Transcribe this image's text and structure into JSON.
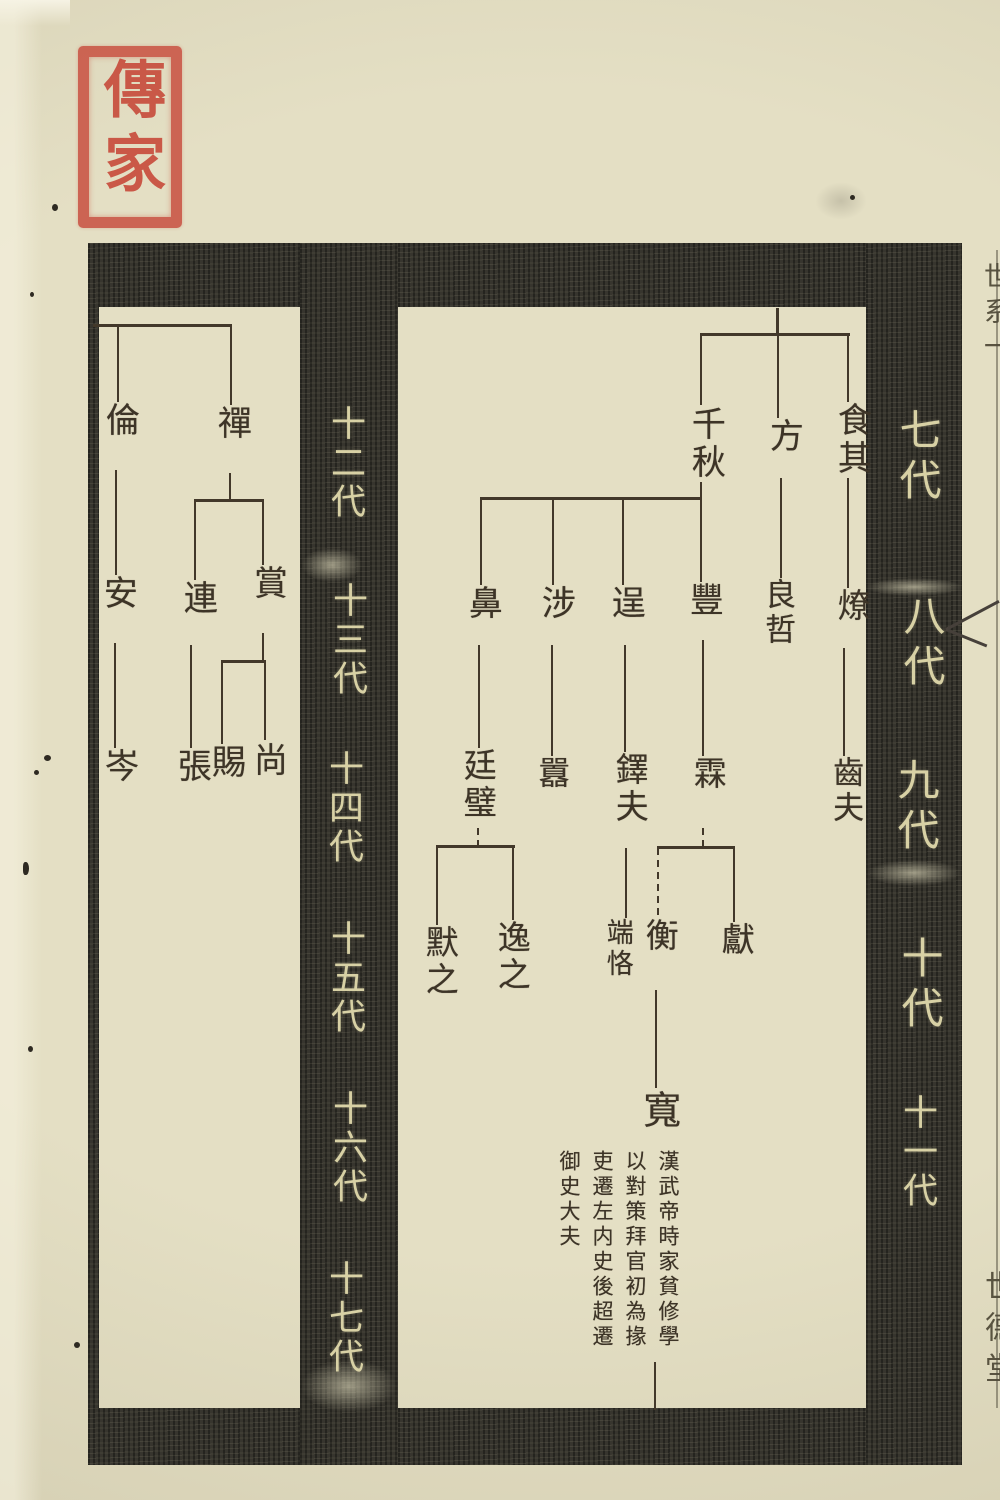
{
  "document": {
    "kind": "woodblock-printed genealogy chart page",
    "colors": {
      "paper": "#e4dfc4",
      "ink": "#3d3427",
      "band": "#32302a",
      "band_text": "#d8d1a5",
      "seal_red": "#c7493a"
    }
  },
  "seal": {
    "text": "傳家"
  },
  "generation_bands": {
    "right_band_labels": [
      "七代",
      "八代",
      "九代",
      "十代",
      "十一代"
    ],
    "center_band_labels": [
      "十二代",
      "十三代",
      "十四代",
      "十五代",
      "十六代",
      "十七代"
    ]
  },
  "names": {
    "qianqiu": "千秋",
    "fang": "方",
    "shiqi": "食其",
    "bi": "鼻",
    "she": "涉",
    "cheng": "逞",
    "feng": "豐",
    "liangzhe": "良哲",
    "liao": "燎",
    "tingbi": "廷璧",
    "xiao": "囂",
    "duofu": "鐸夫",
    "lin": "霖",
    "chifu": "齒夫",
    "mozhi": "默之",
    "yizhi": "逸之",
    "duanke": "端恪",
    "heng": "衡",
    "xian": "獻",
    "kuan": "寬",
    "lun": "倫",
    "chan": "禪",
    "an": "安",
    "lian": "連",
    "shang": "賞",
    "cen": "岑",
    "zhang": "張",
    "si": "賜",
    "shangx": "尚"
  },
  "biography": {
    "text": "漢武帝時家貧修學以對策拜官初為掾吏遷左内史後超遷御史大夫"
  },
  "lineage": {
    "gen7": [
      "千秋",
      "方",
      "食其"
    ],
    "gen8": {
      "千秋": [
        "鼻",
        "涉",
        "逞",
        "豐"
      ],
      "方": [
        "良哲"
      ],
      "食其": [
        "燎"
      ]
    },
    "gen9": {
      "鼻": [
        "廷璧"
      ],
      "涉": [
        "囂"
      ],
      "逞": [
        "鐸夫"
      ],
      "豐": [
        "霖"
      ],
      "燎": [
        "齒夫"
      ]
    },
    "gen10": {
      "廷璧": [
        "默之",
        "逸之"
      ],
      "鐸夫": [
        "端恪"
      ],
      "霖": [
        "衡",
        "獻"
      ]
    },
    "gen11": {
      "衡": [
        "寬"
      ]
    },
    "gen12": [
      "倫",
      "禪"
    ],
    "gen13": {
      "倫": [
        "安"
      ],
      "禪": [
        "連",
        "賞"
      ]
    },
    "gen14": {
      "安": [
        "岑"
      ],
      "連": [
        "張"
      ],
      "賞": [
        "賜",
        "尚"
      ]
    }
  },
  "edge_strip": {
    "top_text": "世系一",
    "bottom_text": "世德堂"
  }
}
